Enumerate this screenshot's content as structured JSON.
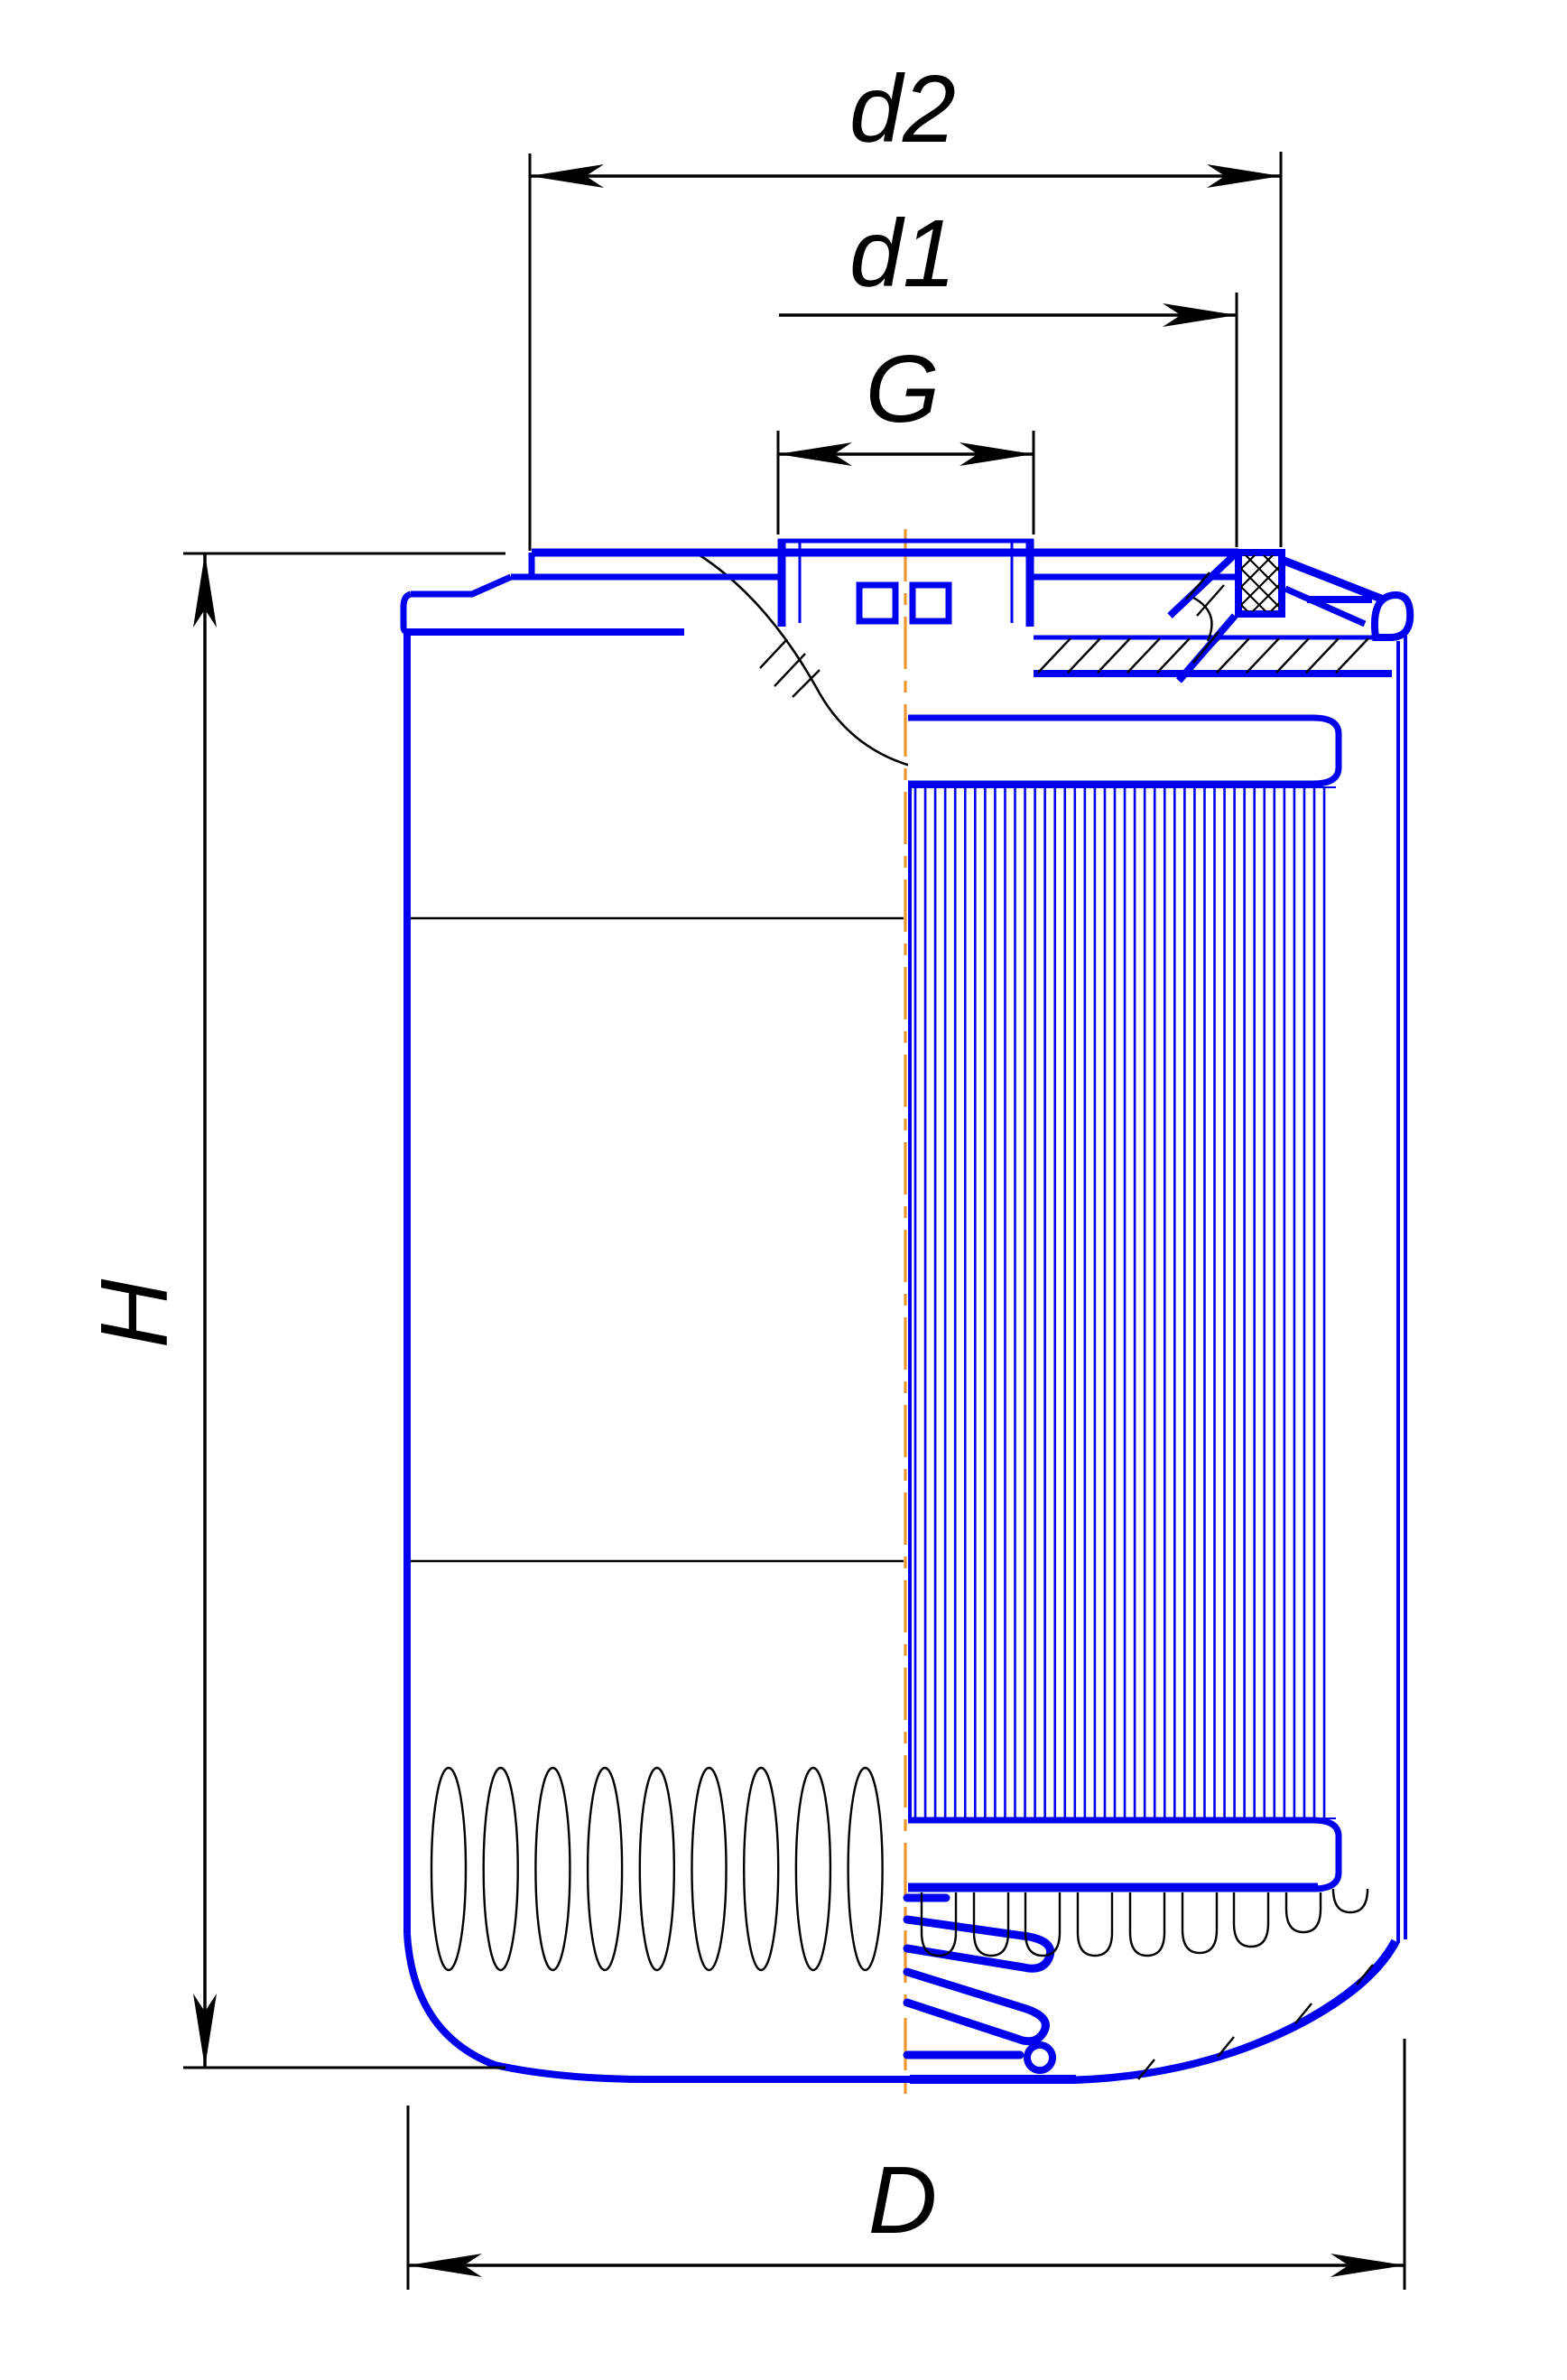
{
  "drawing": {
    "type": "technical-sectional-drawing",
    "subject": "spin-on filter cartridge",
    "dimension_labels": {
      "d2": "d2",
      "d1": "d1",
      "g": "G",
      "h": "H",
      "d_outer": "D"
    },
    "colors": {
      "outline_blue": "#0000EE",
      "dimension_black": "#000000",
      "centerline_orange": "#E8962E",
      "background": "#FFFFFF"
    }
  }
}
